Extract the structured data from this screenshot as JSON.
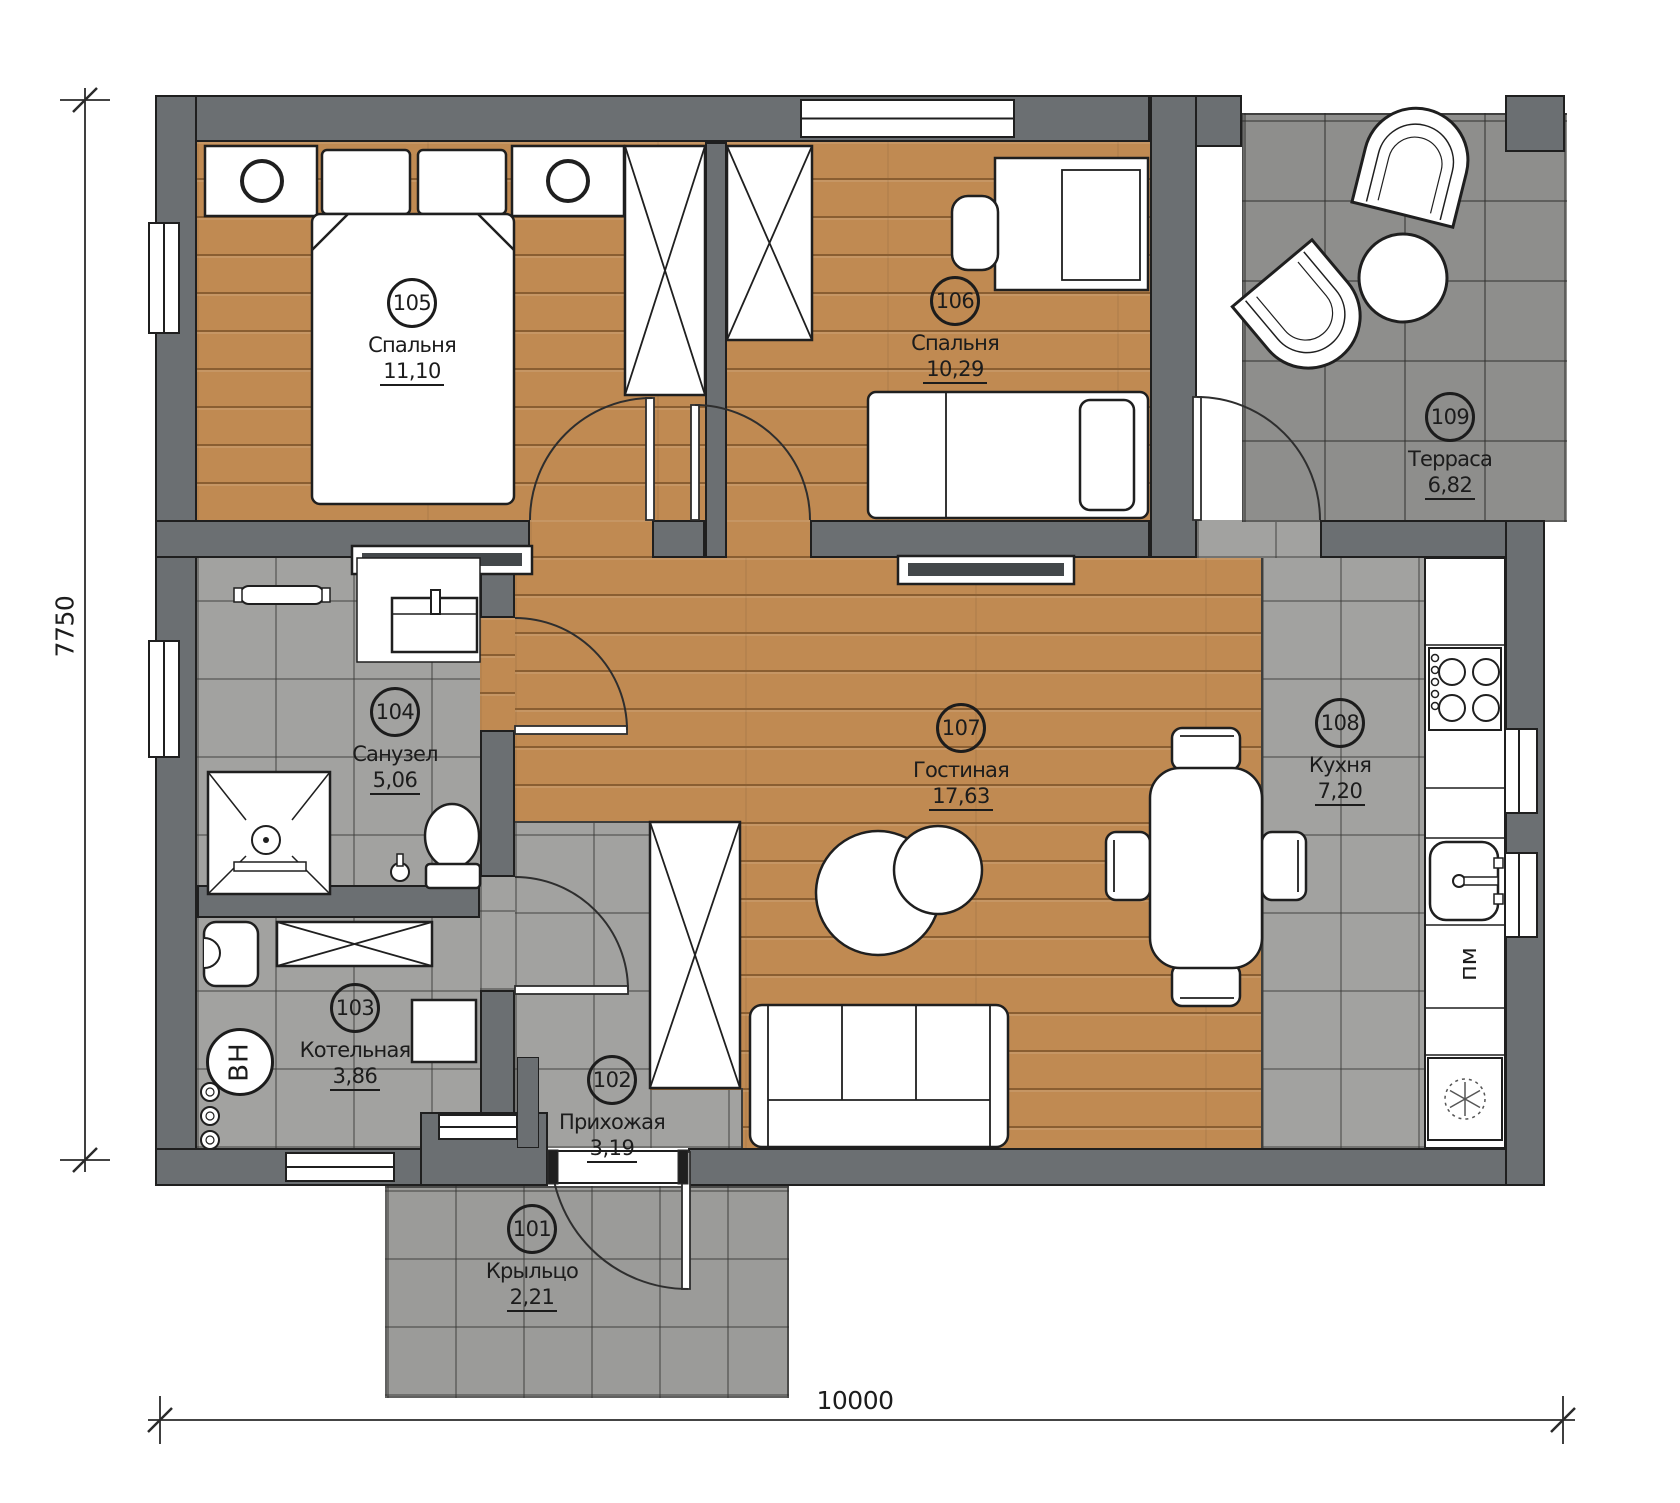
{
  "plan": {
    "title": "Floor plan with room areas",
    "rooms": [
      {
        "number": "101",
        "name": "Крыльцо",
        "area": "2,21"
      },
      {
        "number": "102",
        "name": "Прихожая",
        "area": "3,19"
      },
      {
        "number": "103",
        "name": "Котельная",
        "area": "3,86"
      },
      {
        "number": "104",
        "name": "Санузел",
        "area": "5,06"
      },
      {
        "number": "105",
        "name": "Спальня",
        "area": "11,10"
      },
      {
        "number": "106",
        "name": "Спальня",
        "area": "10,29"
      },
      {
        "number": "107",
        "name": "Гостиная",
        "area": "17,63"
      },
      {
        "number": "108",
        "name": "Кухня",
        "area": "7,20"
      },
      {
        "number": "109",
        "name": "Терраса",
        "area": "6,82"
      }
    ],
    "dimensions": {
      "horizontal": "10000",
      "vertical": "7750"
    },
    "markings": {
      "water_heater": "ВН",
      "dishwasher": "пм"
    },
    "colors": {
      "wall": "#6b6f72",
      "wood": "#c08a52",
      "tile": "#a2a2a0",
      "terrace_tile": "#8e8e8c"
    }
  }
}
